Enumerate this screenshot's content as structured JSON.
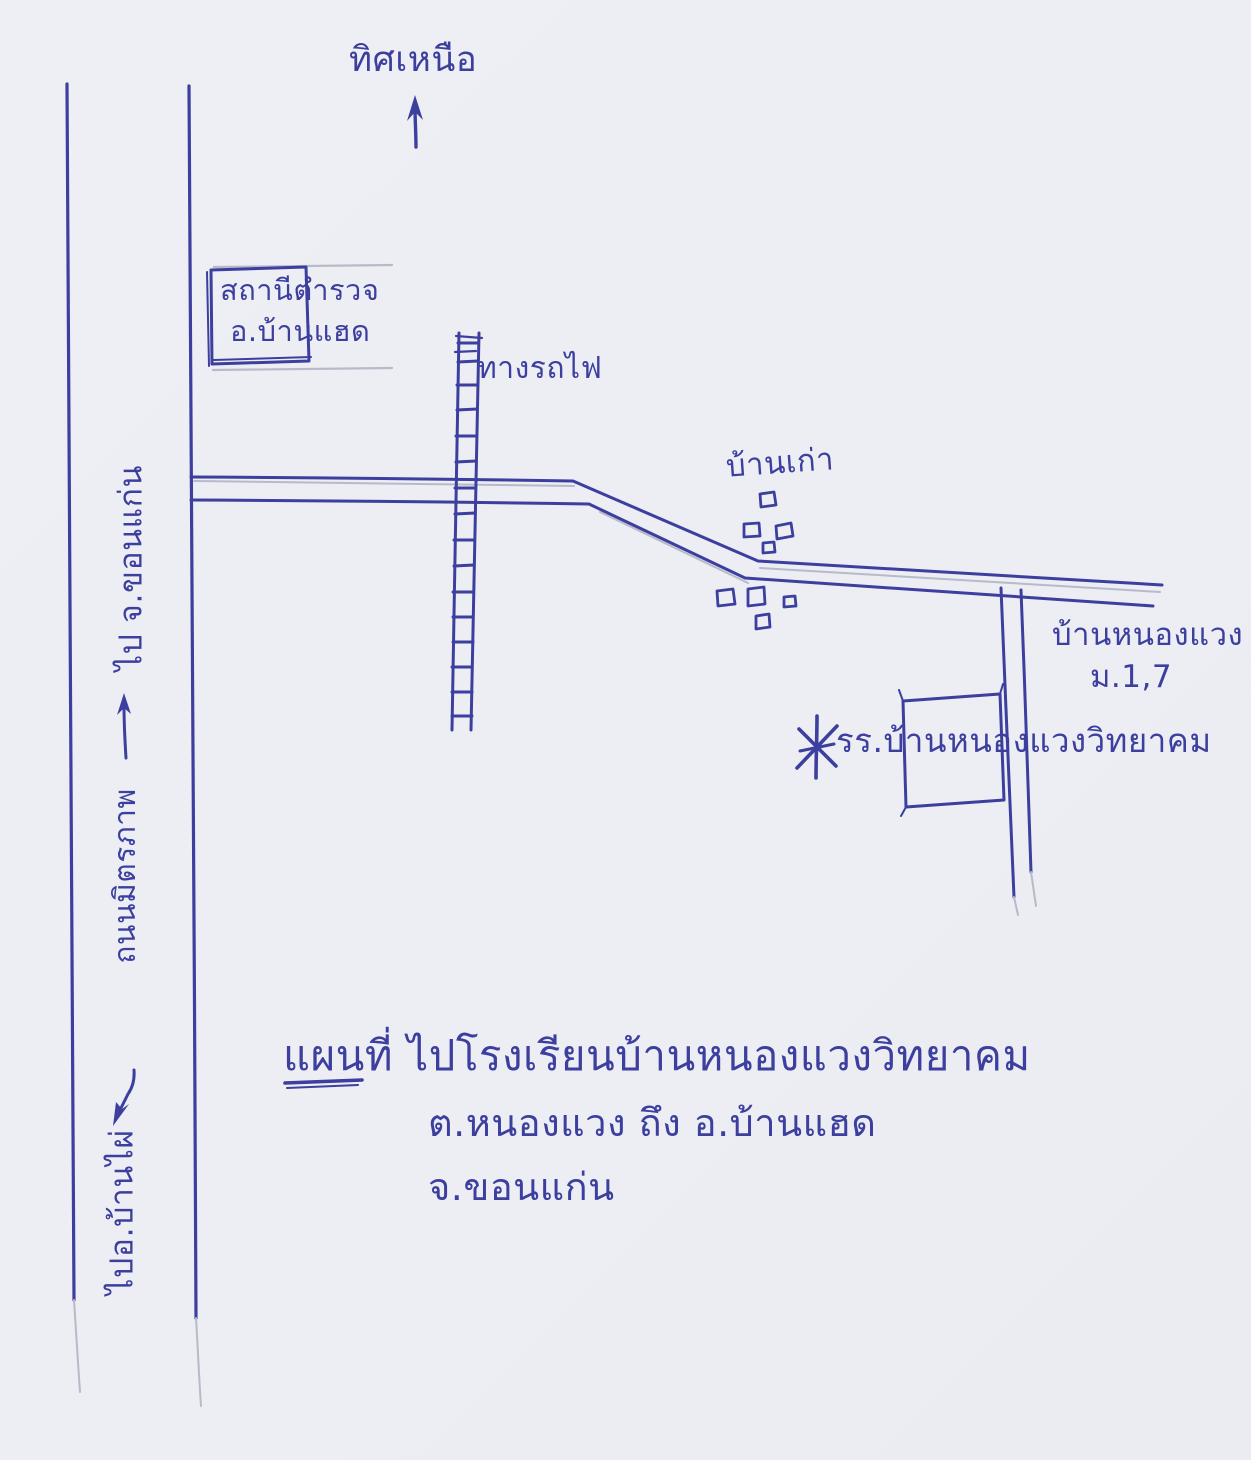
{
  "page": {
    "ink": "#3c3f9e",
    "ink_soft": "#4a4db0",
    "pencil": "#b7bac8",
    "paper": "#edeff5"
  },
  "compass": {
    "north_label": "ทิศเหนือ"
  },
  "places": {
    "police_station_line1": "สถานีตำรวจ",
    "police_station_line2": "อ.บ้านแฮด",
    "railway_label": "ทางรถไฟ",
    "old_village_label": "บ้านเก่า",
    "village_name": "บ้านหนองแวง",
    "village_moo": "ม.1,7",
    "school_name": "รร.บ้านหนองแวงวิทยาคม"
  },
  "roads": {
    "to_khon_kaen": "ไป จ.ขอนแก่น",
    "mittraphap_road": "ถนนมิตรภาพ",
    "to_ban_phai": "ไปอ.บ้านไผ่"
  },
  "title": {
    "map_word": "แผนที่",
    "line1_rest": "ไปโรงเรียนบ้านหนองแวงวิทยาคม",
    "line2": "ต.หนองแวง ถึง อ.บ้านแฮด",
    "line3": "จ.ขอนแก่น"
  },
  "icons": {
    "north_arrow": "north-arrow",
    "khon_kaen_arrow": "arrow-up",
    "ban_phai_arrow": "arrow-down",
    "school_marker": "asterisk"
  }
}
